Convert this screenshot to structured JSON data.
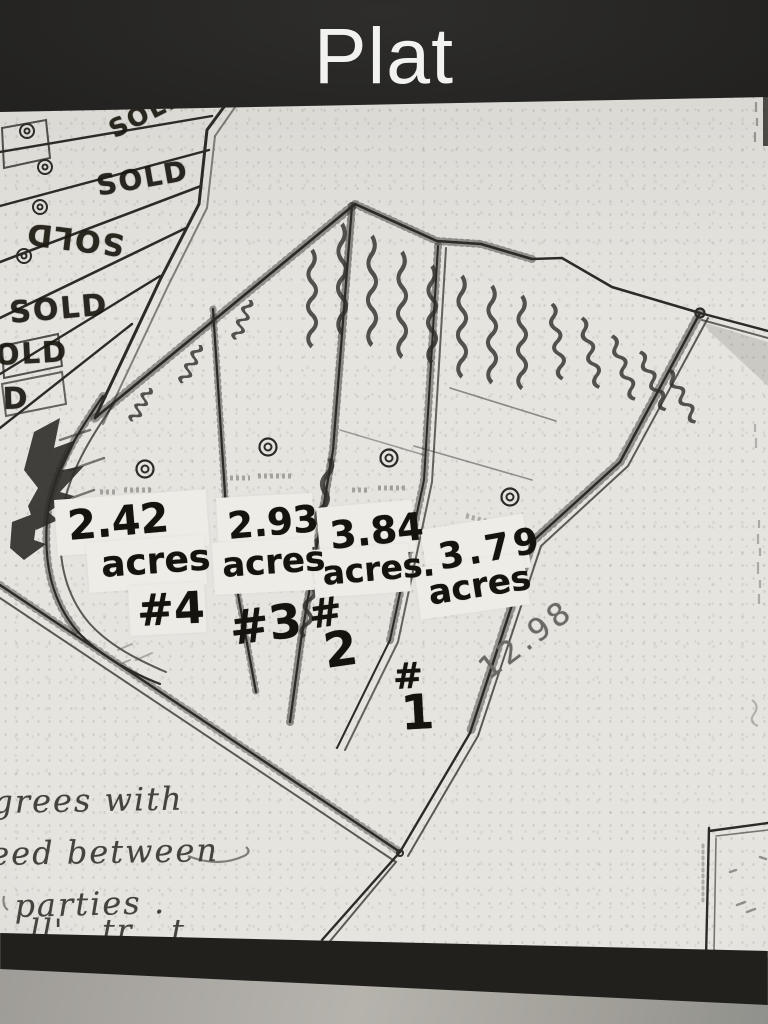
{
  "header": {
    "title": "Plat"
  },
  "photo": {
    "description": "black-and-white photocopied plat map with handwritten lot sizes",
    "sold_stamps": [
      {
        "label": "SOLD"
      },
      {
        "label": "SOLD"
      },
      {
        "label": "SOLD"
      },
      {
        "label": "SOLD"
      },
      {
        "label": "OLD"
      },
      {
        "label": "D"
      }
    ],
    "lots": [
      {
        "hash": "#",
        "num": "4",
        "acres": "2.42",
        "unit": "acres"
      },
      {
        "hash": "#",
        "num": "3",
        "acres": "2.93",
        "unit": "acres"
      },
      {
        "hash": "#",
        "num": "2",
        "acres": "3.84",
        "unit": "acres."
      },
      {
        "hash": "#",
        "num": "1",
        "acres": "3.79",
        "unit": "acres"
      }
    ],
    "measurement": "12.98",
    "notes": {
      "line1": "grees with",
      "line2": "eed between",
      "line3": "parties .",
      "line4_partial": "ll'  tr  t"
    },
    "colors": {
      "caption_bg": "#232220",
      "caption_text": "#f2f2f0",
      "paper": "#e6e4df",
      "ink": "#2d2b27",
      "marker": "#15130e",
      "pencil": "#6b6965",
      "surface": "#a8a5a0"
    }
  }
}
